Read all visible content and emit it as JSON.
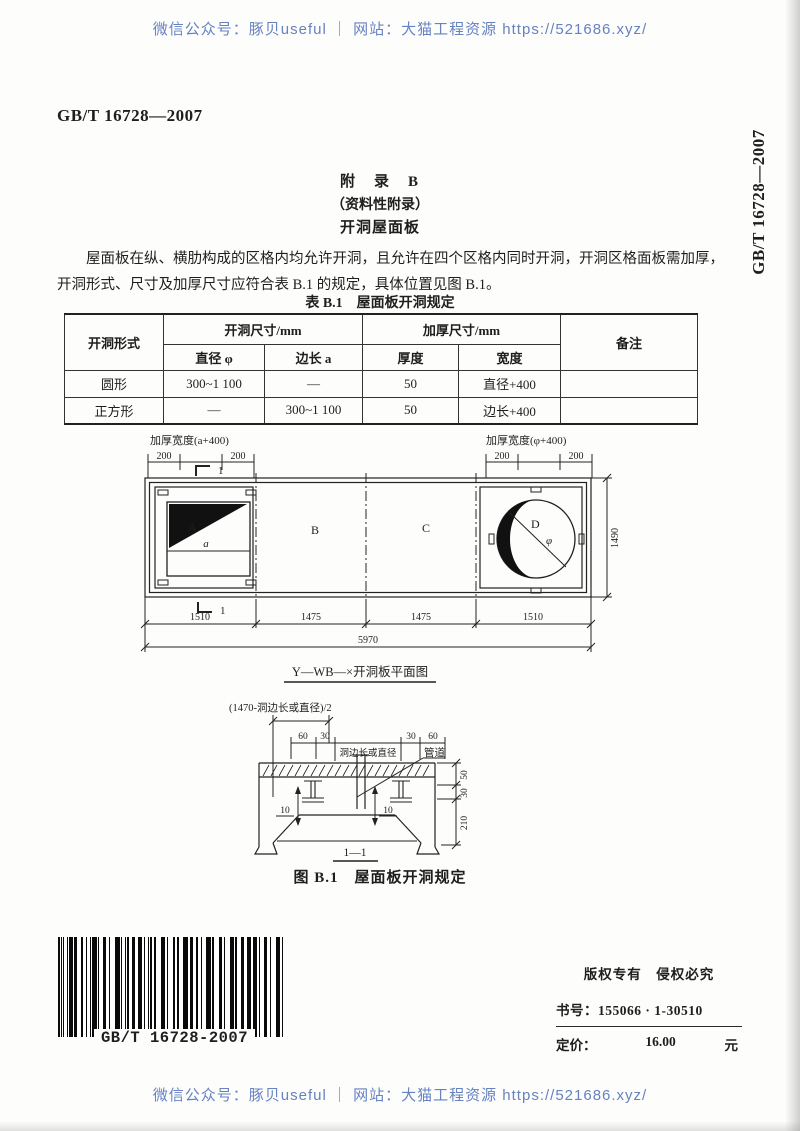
{
  "watermark": {
    "top": "微信公众号：豚贝useful ｜ 网站：大猫工程资源 https://521686.xyz/",
    "bottom": "微信公众号：豚贝useful ｜ 网站：大猫工程资源 https://521686.xyz/",
    "color": "#6682c2"
  },
  "header": {
    "doc_number": "GB/T 16728—2007",
    "side_doc_number": "GB/T 16728—2007"
  },
  "appendix": {
    "title": "附　录　B",
    "subtitle": "（资料性附录）",
    "section_title": "开洞屋面板"
  },
  "paragraph": {
    "line1": "屋面板在纵、横肋构成的区格内均允许开洞，且允许在四个区格内同时开洞，开洞区格面板需加厚，",
    "line2": "开洞形式、尺寸及加厚尺寸应符合表 B.1 的规定，具体位置见图 B.1。"
  },
  "table": {
    "title": "表 B.1　屋面板开洞规定",
    "headers": {
      "col_shape": "开洞形式",
      "group_opening": "开洞尺寸/mm",
      "group_thicken": "加厚尺寸/mm",
      "col_remark": "备注",
      "sub_diameter": "直径 φ",
      "sub_side": "边长 a",
      "sub_thickness": "厚度",
      "sub_width": "宽度"
    },
    "rows": [
      {
        "shape": "圆形",
        "diameter": "300~1 100",
        "side": "—",
        "thickness": "50",
        "width": "直径+400",
        "remark": ""
      },
      {
        "shape": "正方形",
        "diameter": "—",
        "side": "300~1 100",
        "thickness": "50",
        "width": "边长+400",
        "remark": ""
      }
    ]
  },
  "plan": {
    "left_thicken_label": "加厚宽度(a+400)",
    "right_thicken_label": "加厚宽度(φ+400)",
    "dim_200": "200",
    "section_mark": "1",
    "region_a": "A",
    "region_b": "B",
    "region_c": "C",
    "region_d": "D",
    "square_dim": "a",
    "circle_dim": "φ",
    "circle_region": "D",
    "height_dim": "1490",
    "bottom_dims": [
      "1510",
      "1475",
      "1475",
      "1510"
    ],
    "total_dim": "5970",
    "caption": "Y—WB—×开洞板平面图"
  },
  "section": {
    "offset_label": "(1470-洞边长或直径)/2",
    "dim_60": "60",
    "dim_30": "30",
    "opening_dim_label": "洞边长或直径",
    "callout": "管道",
    "dim_10": "10",
    "dim_50": "50",
    "dim_30r": "30",
    "dim_210": "210",
    "caption": "1—1"
  },
  "figure_caption": "图 B.1　屋面板开洞规定",
  "footer": {
    "barcode_label": "GB/T 16728-2007",
    "copyright": "版权专有　侵权必究",
    "book_no_label": "书号：",
    "book_no": "155066 · 1-30510",
    "price_label": "定价：",
    "price_value": "16.00",
    "price_unit": "元"
  }
}
